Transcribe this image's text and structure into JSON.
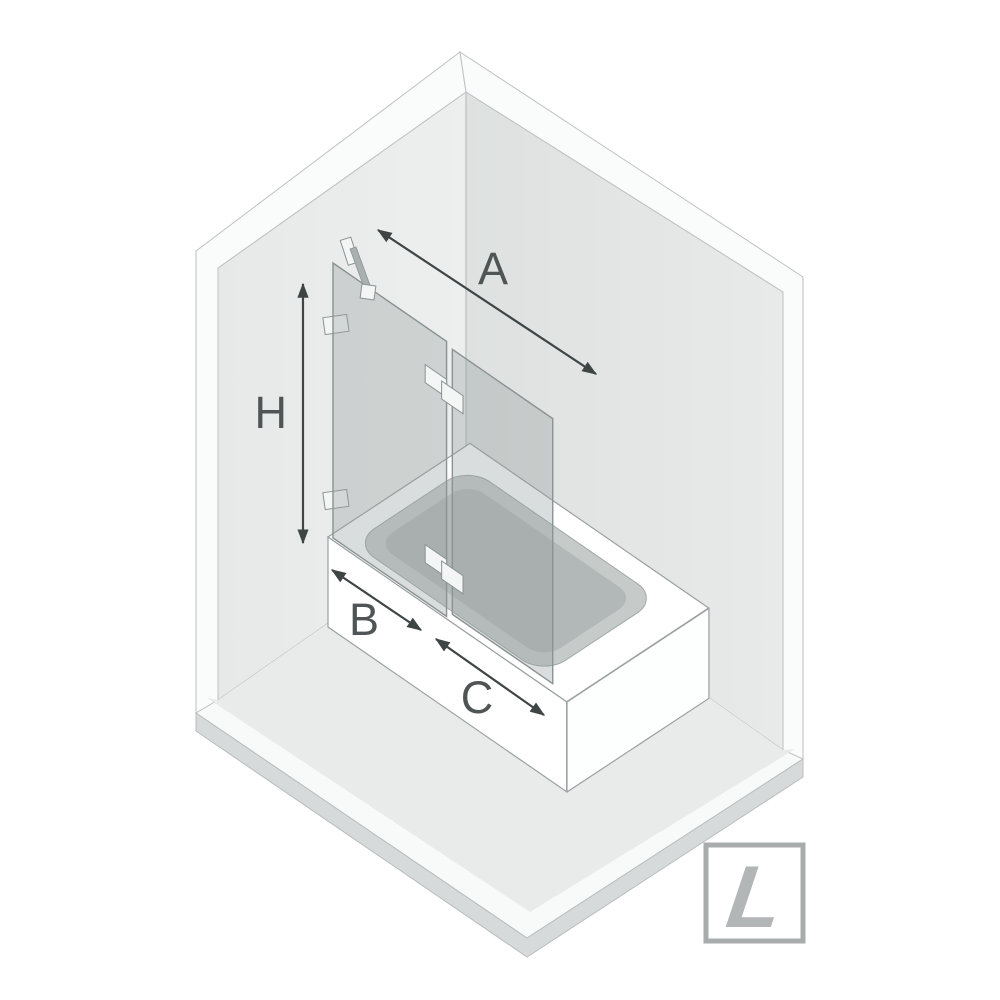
{
  "diagram": {
    "subject": "bathtub screen dimension diagram, isometric room view",
    "dimension_labels": {
      "total_width": "A",
      "height": "H",
      "fixed_panel_width": "B",
      "door_panel_width": "C"
    },
    "orientation_badge": {
      "letter": "L"
    },
    "colors": {
      "background": "#ffffff",
      "wall_left_face": "#eaecec",
      "wall_right_face": "#e2e5e4",
      "wall_edge_band": "#fafbfb",
      "floor_surface": "#e9ebeb",
      "floor_front_strip": "#f8f9f9",
      "floor_side_band": "#d7dada",
      "outline": "#9aa0a0",
      "bathtub": "#ffffff",
      "basin_slope": "#c6cbca",
      "basin_floor": "#b2b8b7",
      "glass": "rgba(150,158,158,0.35)",
      "arrow": "#3f4545",
      "label_text": "#4f5455",
      "badge_border": "#a8acac",
      "badge_letter": "#b2b6b6"
    }
  }
}
